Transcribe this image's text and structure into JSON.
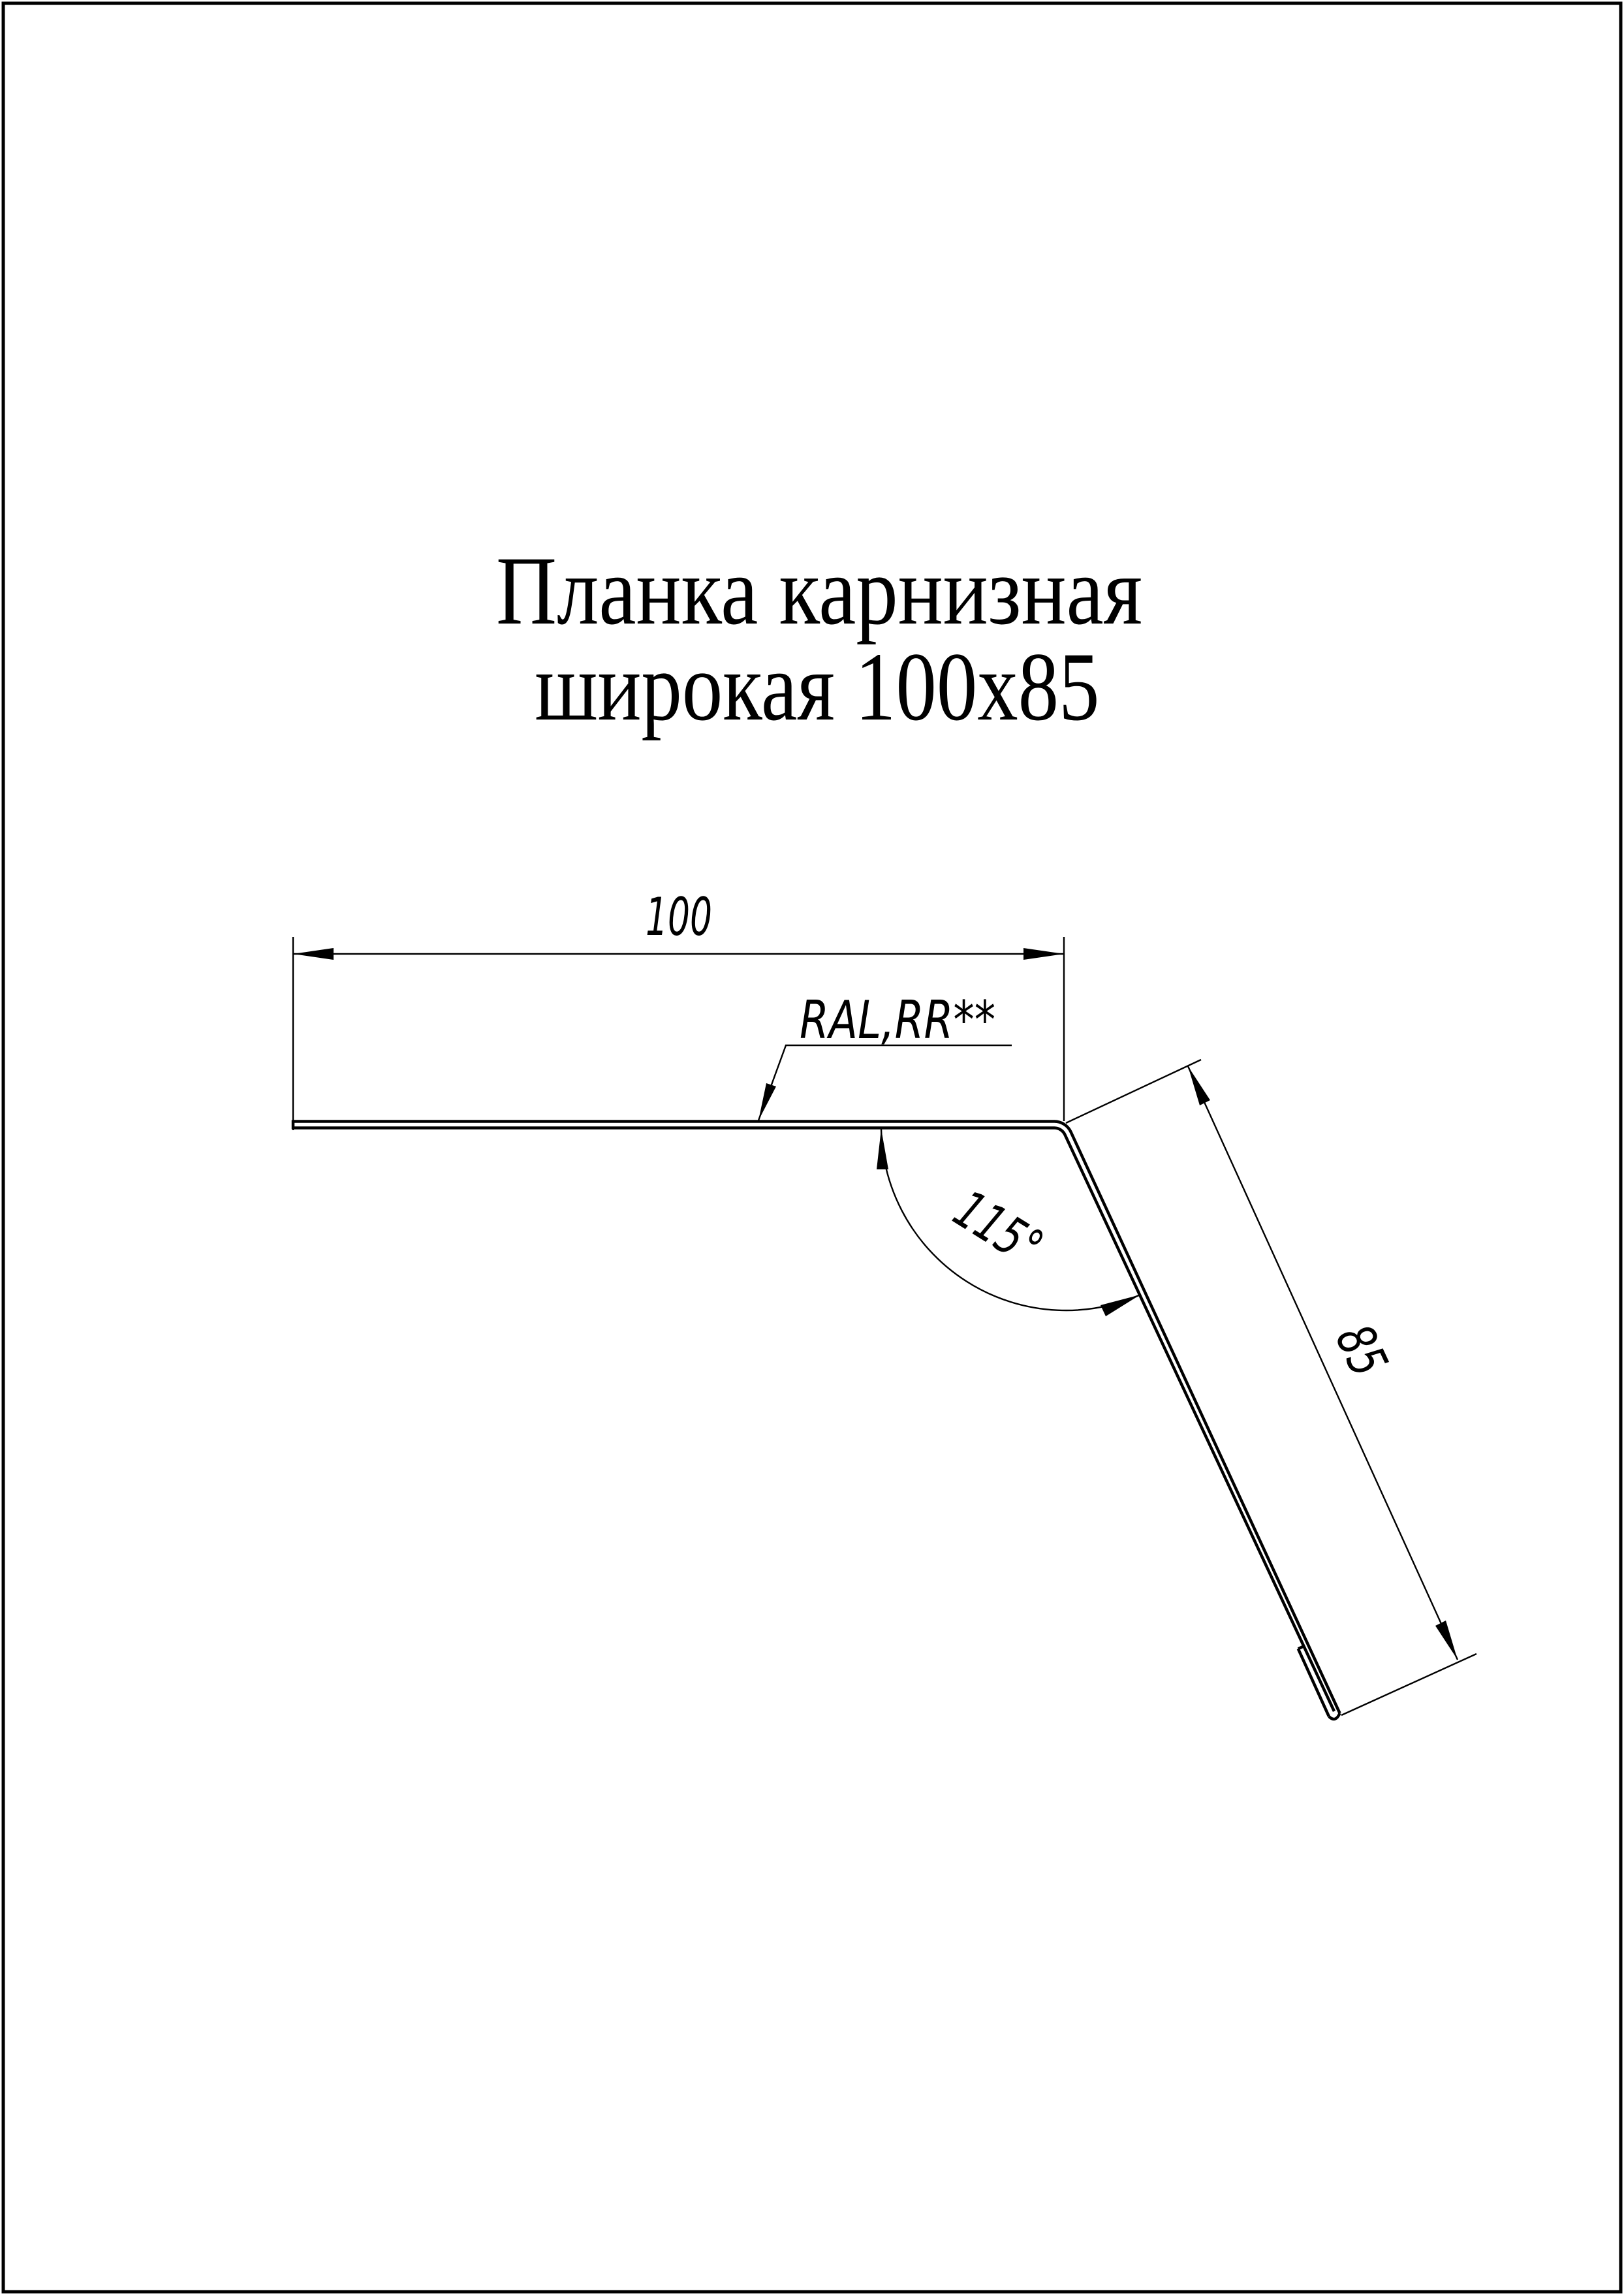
{
  "page": {
    "background_color": "#ffffff",
    "line_color": "#000000"
  },
  "title": {
    "line1": "Планка карнизная",
    "line2": "широкая 100х85"
  },
  "drawing": {
    "width_label": "100",
    "height_label": "85",
    "angle_label": "115°",
    "coating_label": "RAL,RR**"
  }
}
